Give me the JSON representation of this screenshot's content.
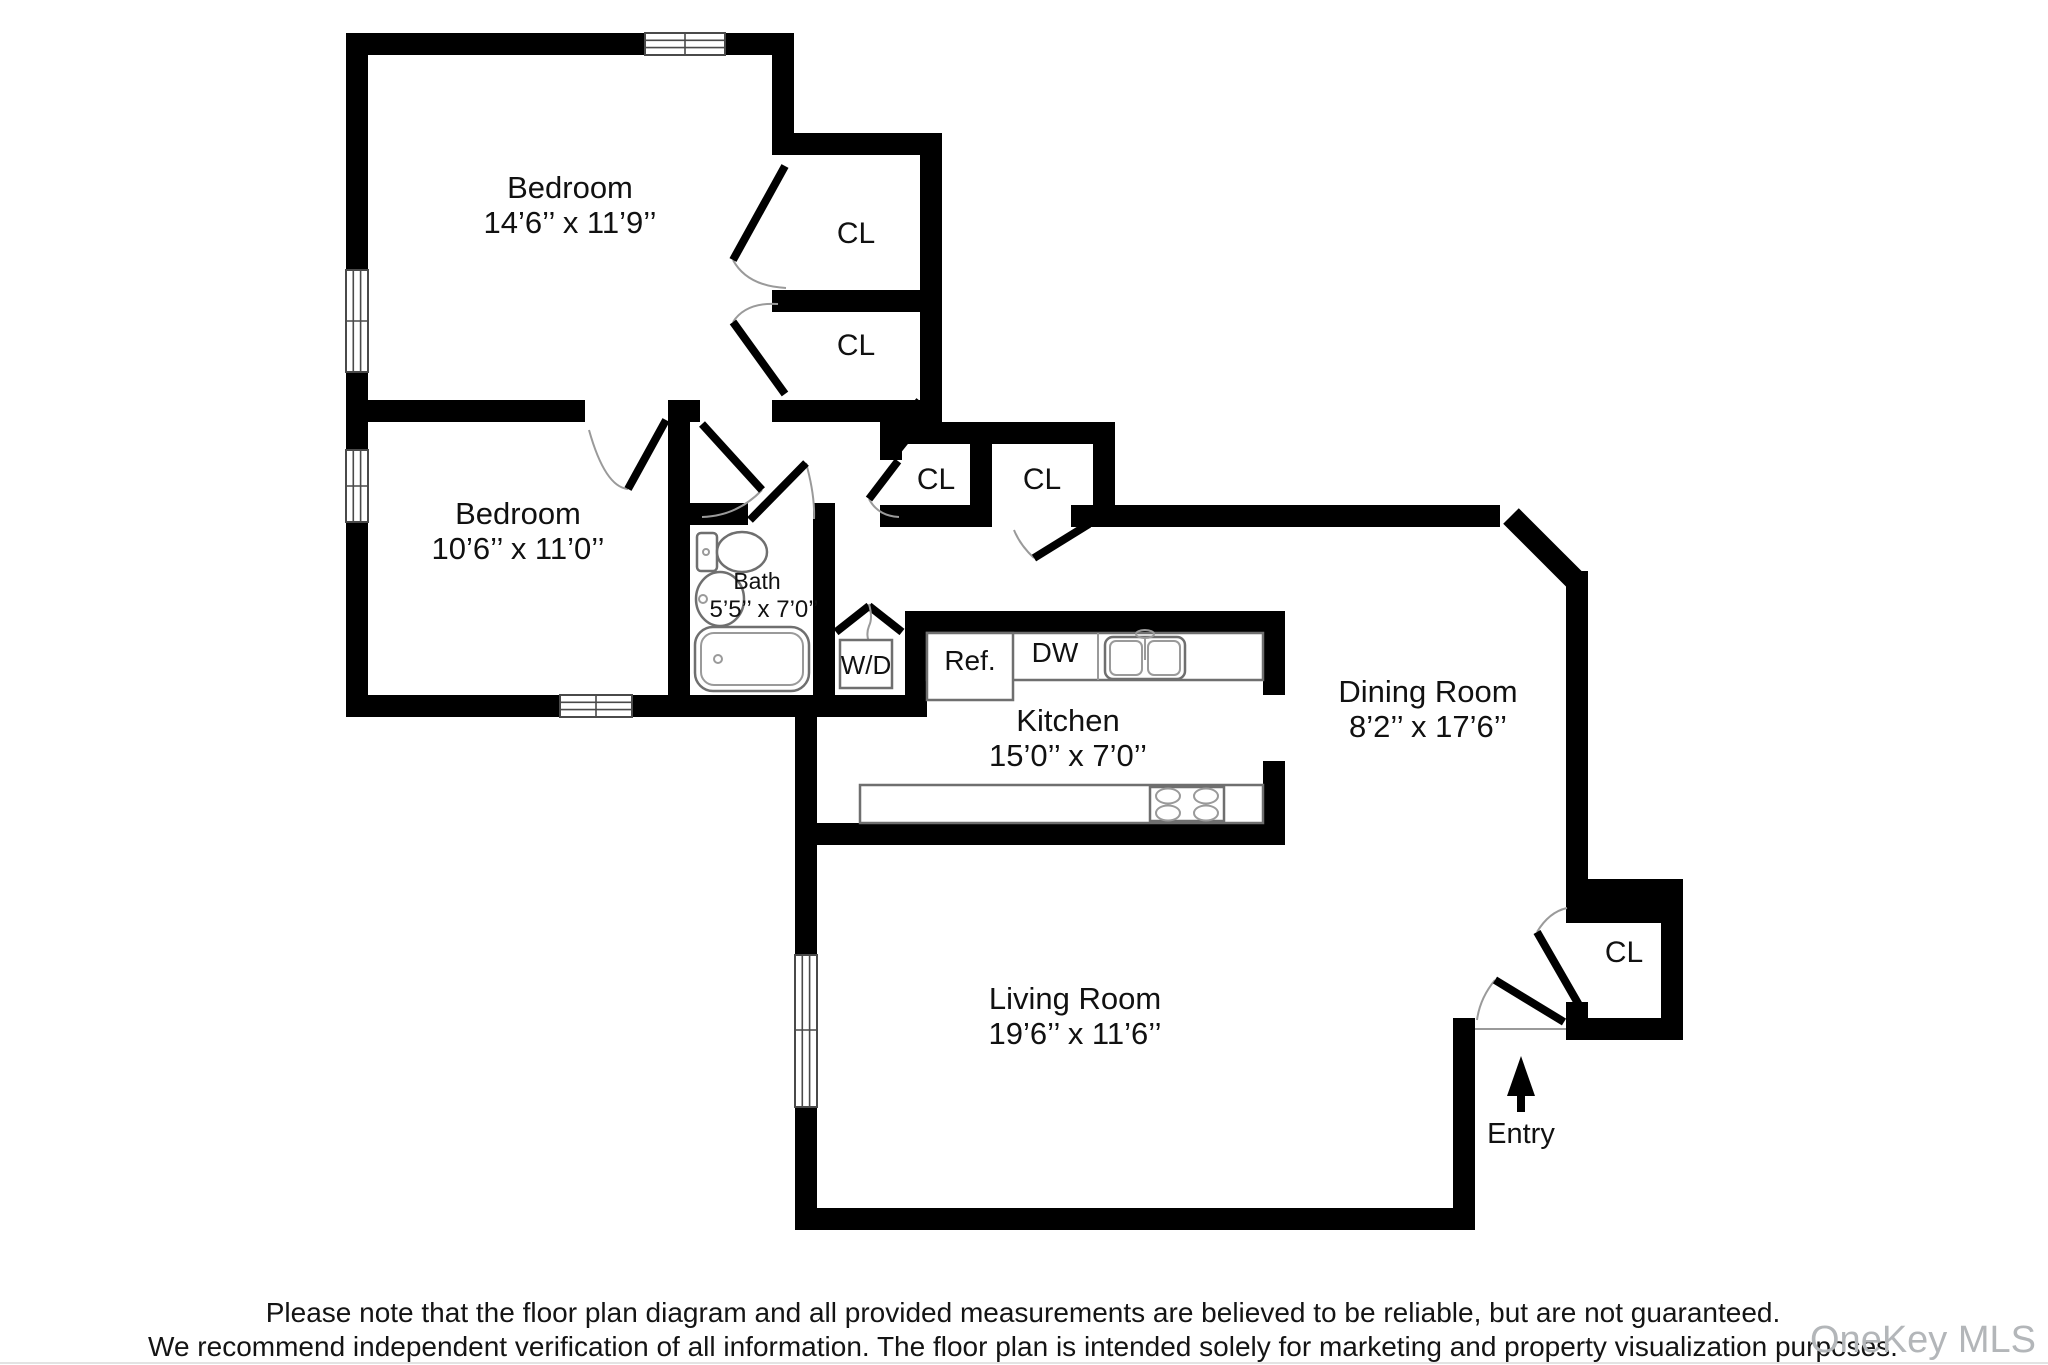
{
  "plan": {
    "rooms": {
      "bedroom_1": {
        "name": "Bedroom",
        "dims": "14’6’’ x 11’9’’"
      },
      "bedroom_2": {
        "name": "Bedroom",
        "dims": "10’6’’ x 11’0’’"
      },
      "bath": {
        "name": "Bath",
        "dims": "5’5’’ x 7’0’’"
      },
      "kitchen": {
        "name": "Kitchen",
        "dims": "15’0’’ x 7’0’’"
      },
      "dining_room": {
        "name": "Dining Room",
        "dims": "8’2’’ x 17’6’’"
      },
      "living_room": {
        "name": "Living Room",
        "dims": "19’6’’ x 11’6’’"
      }
    },
    "closets": [
      {
        "label": "CL"
      },
      {
        "label": "CL"
      },
      {
        "label": "CL"
      },
      {
        "label": "CL"
      },
      {
        "label": "CL"
      }
    ],
    "fixtures": {
      "washer_dryer": "W/D",
      "refrigerator": "Ref.",
      "dishwasher": "DW"
    },
    "entry_label": "Entry"
  },
  "footer": {
    "disclaimer_line_1": "Please note that the floor plan diagram and all provided measurements are believed to be reliable, but are not guaranteed.",
    "disclaimer_line_2": "We recommend independent verification of all information. The floor plan is intended solely for marketing and property visualization purposes."
  },
  "watermark": "OneKey MLS"
}
